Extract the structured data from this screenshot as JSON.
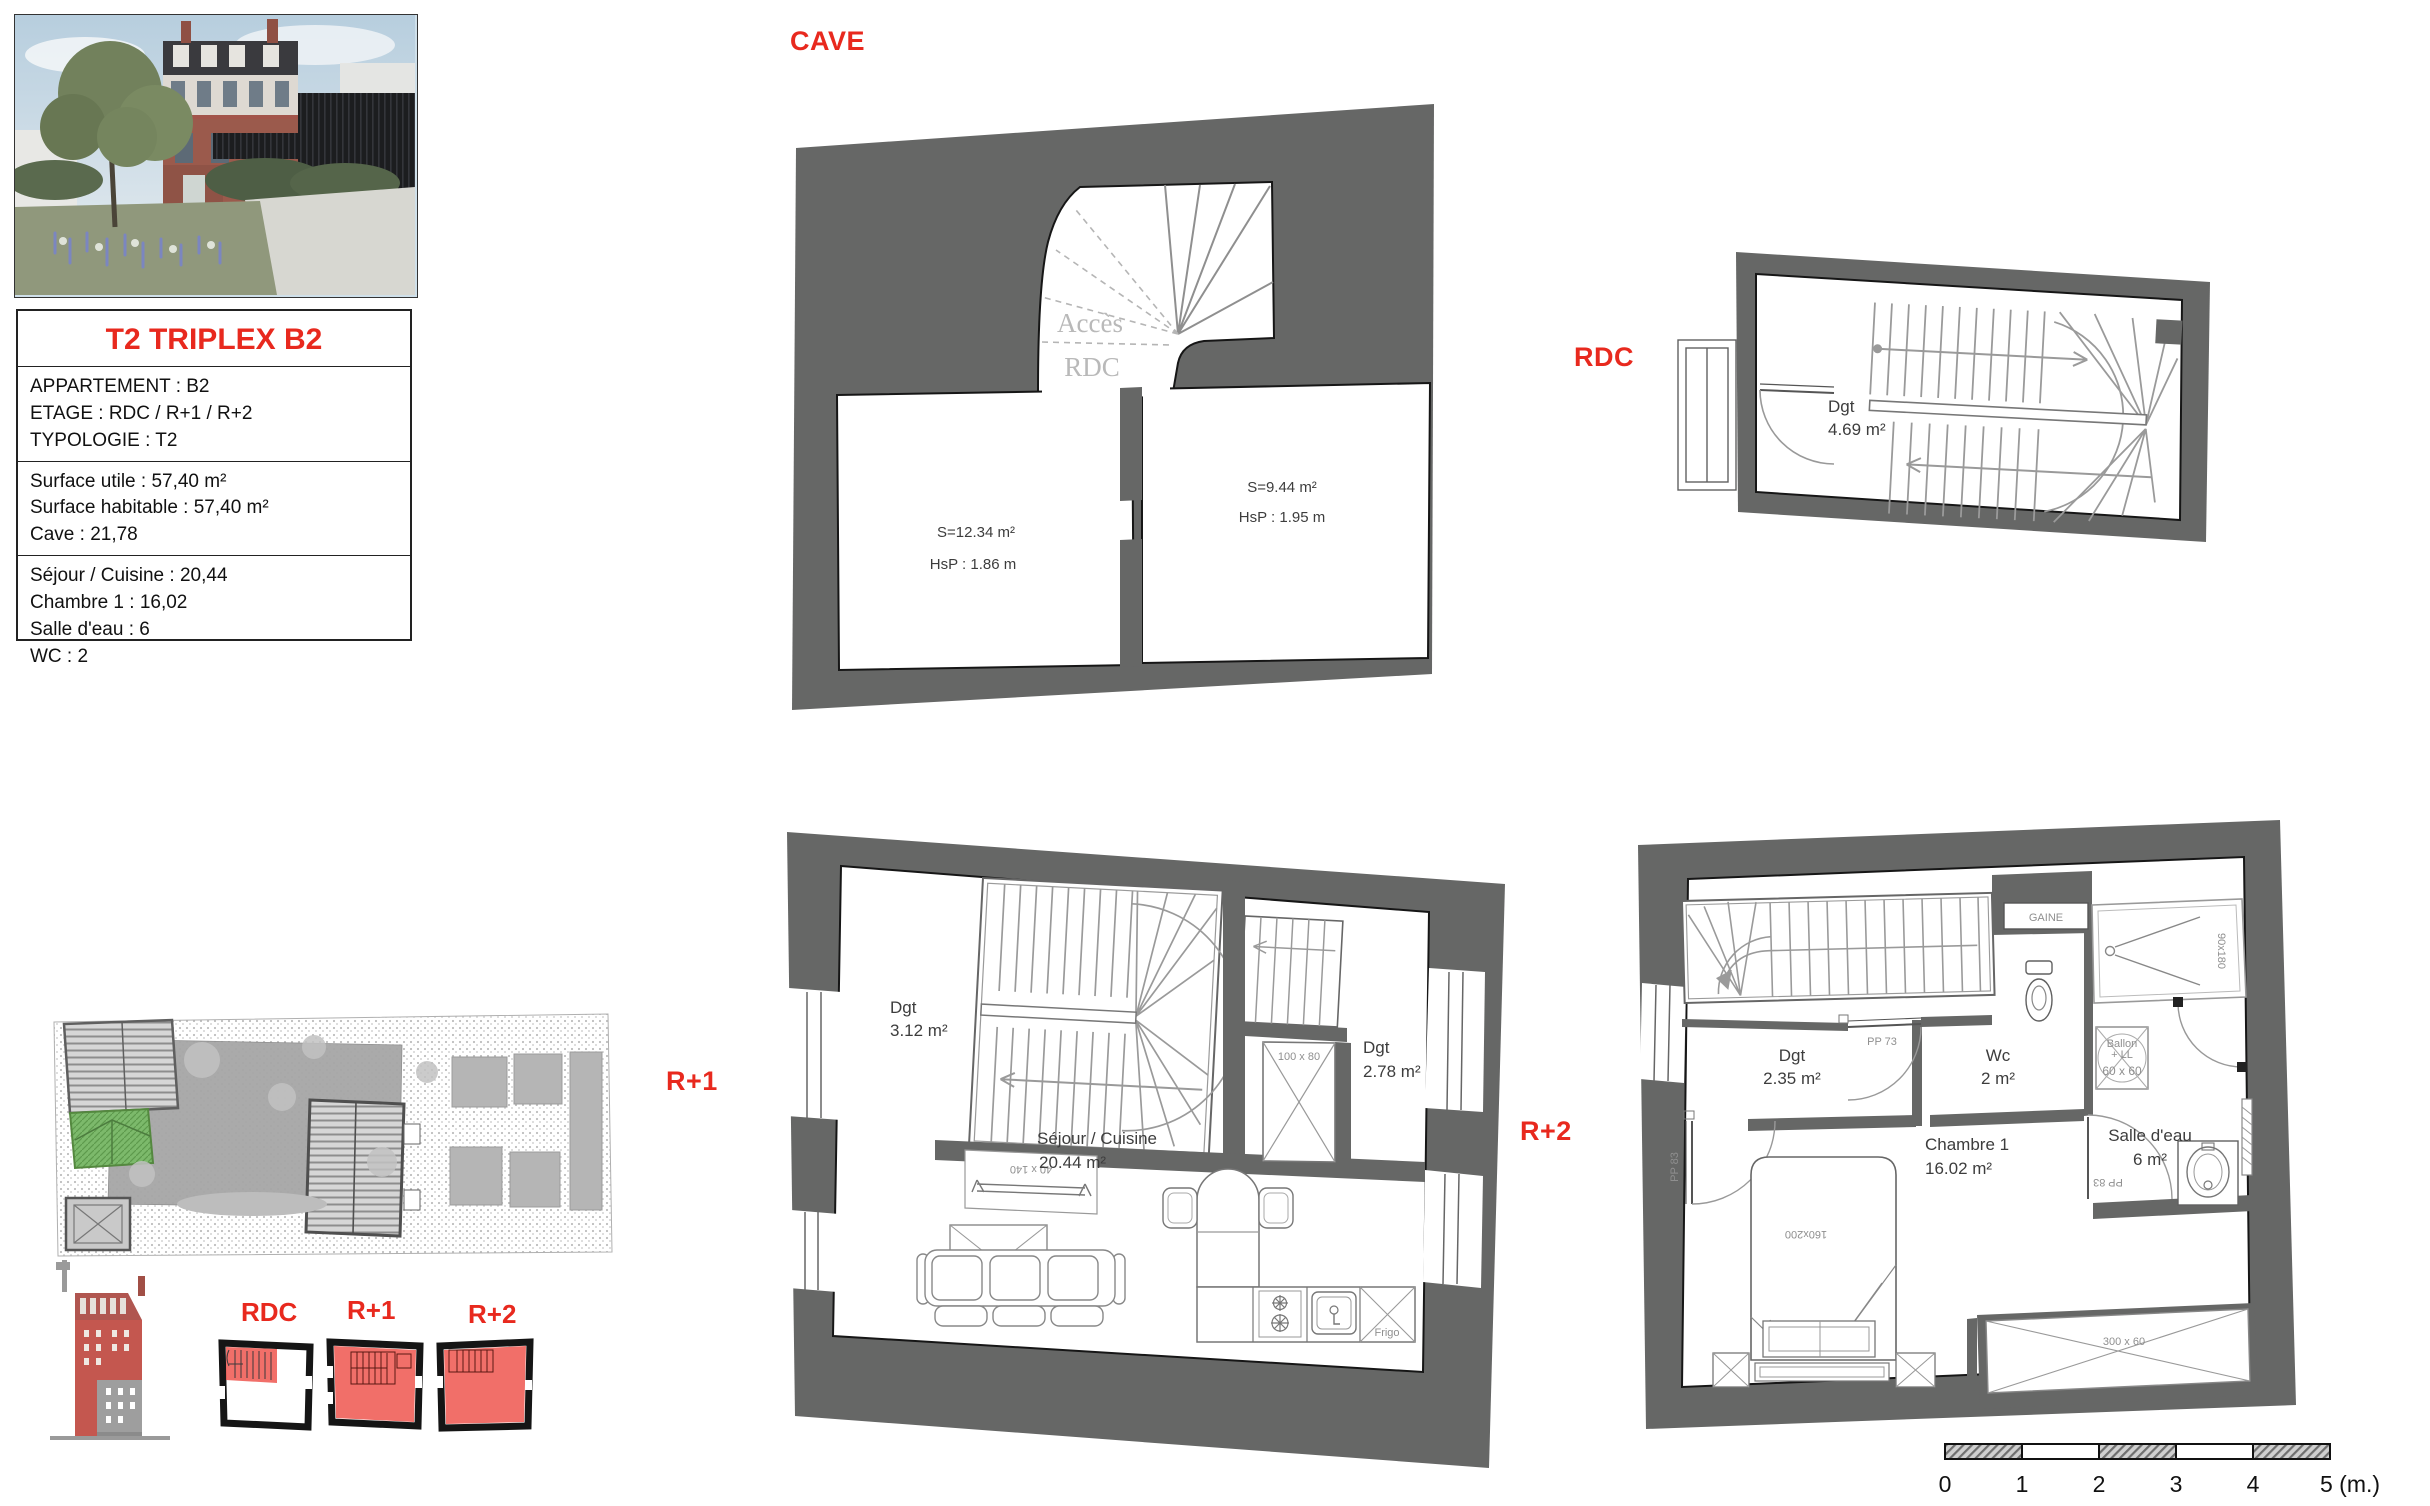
{
  "colors": {
    "accent_red": "#e8291e",
    "wall_gray": "#666766",
    "key_plan_red": "#ee4b43",
    "site_green": "#7cb96b",
    "light_note_gray": "#b9b9b9"
  },
  "title_block": {
    "title": "T2 TRIPLEX B2",
    "apartment": "APPARTEMENT : B2",
    "floor": "ETAGE : RDC / R+1 / R+2",
    "typology": "TYPOLOGIE : T2",
    "surface_utile": "Surface utile : 57,40 m²",
    "surface_habitable": "Surface habitable : 57,40 m²",
    "cave": "Cave : 21,78",
    "sejour": "Séjour / Cuisine : 20,44",
    "chambre": "Chambre 1 : 16,02",
    "salle_eau": "Salle d'eau : 6",
    "wc": "WC : 2"
  },
  "floor_labels": {
    "cave": "CAVE",
    "rdc": "RDC",
    "r1": "R+1",
    "r2": "R+2"
  },
  "cave_plan": {
    "access_line1": "Accès",
    "access_line2": "RDC",
    "room1_area": "S=12.34 m²",
    "room1_height": "HsP : 1.86 m",
    "room2_area": "S=9.44 m²",
    "room2_height": "HsP : 1.95 m"
  },
  "rdc_plan": {
    "dgt_label": "Dgt",
    "dgt_area": "4.69 m²"
  },
  "r1_plan": {
    "dgt1_label": "Dgt",
    "dgt1_area": "3.12 m²",
    "dgt2_label": "Dgt",
    "dgt2_area": "2.78 m²",
    "skylight_dim": "100 x 80",
    "window_dim": "40 x 140",
    "sejour_label": "Séjour / Cuisine",
    "sejour_area": "20.44 m²",
    "frigo_label": "Frigo"
  },
  "r2_plan": {
    "gaine_label": "GAINE",
    "dgt_label": "Dgt",
    "dgt_area": "2.35 m²",
    "wc_label": "Wc",
    "wc_area": "2 m²",
    "door1_dim": "PP 73",
    "door2_dim": "PP 83",
    "door3_dim": "PP 83",
    "shower_dim": "90x180",
    "ballon_line1": "Ballon",
    "ballon_line2": "+ LL",
    "ballon_dim": "60 x 60",
    "sde_label": "Salle d'eau",
    "sde_area": "6 m²",
    "chambre_label": "Chambre 1",
    "chambre_area": "16.02 m²",
    "bed_dim": "160x200",
    "window_dim": "300 x 60"
  },
  "key_plans": {
    "rdc_label": "RDC",
    "r1_label": "R+1",
    "r2_label": "R+2"
  },
  "scale_bar": {
    "t0": "0",
    "t1": "1",
    "t2": "2",
    "t3": "3",
    "t4": "4",
    "t5": "5 (m.)"
  }
}
